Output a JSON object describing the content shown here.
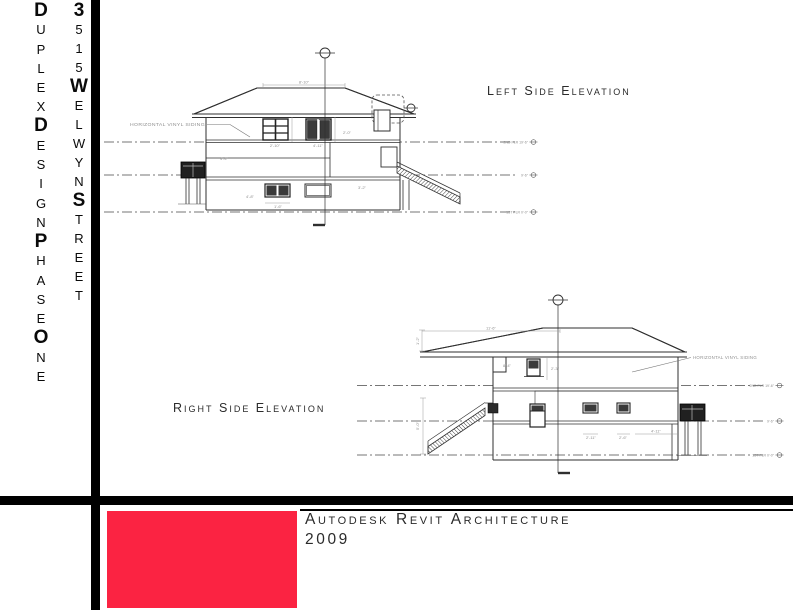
{
  "sidebar": {
    "column1": {
      "text": "DUPLEX DESIGN PHASE ONE",
      "letters": "DUPLEXDESIGNPHASEONE",
      "bold_indices": [
        0,
        6,
        12,
        17
      ]
    },
    "column2": {
      "text": "3515 WELWYN STREET",
      "letters": "3515WELWYNSTREET",
      "bold_indices": [
        0,
        4,
        10
      ]
    }
  },
  "drawings": {
    "left_elevation": {
      "title": "Left Side Elevation",
      "siding_label": "HORIZONTAL VINYL SIDING",
      "levels": [
        {
          "label": "2ND FLR 19'-6\""
        },
        {
          "label": "9'-6\""
        },
        {
          "label": "1ST FLR 0'-0\""
        }
      ],
      "dims": [
        "8'-10\"",
        "2'-10\"",
        "4'-11\"",
        "4'-4\"",
        "2'-0\"",
        "4'-8\"",
        "1'-6\"",
        "3'-2\""
      ]
    },
    "right_elevation": {
      "title": "Right Side Elevation",
      "siding_label": "HORIZONTAL VINYL SIDING",
      "levels": [
        {
          "label": "2ND FLR 19'-6\""
        },
        {
          "label": "9'-6\""
        },
        {
          "label": "1ST FLR 0'-0\""
        }
      ],
      "dims": [
        "2'-3\"",
        "2'-11\"",
        "2'-6\"",
        "4'-11\"",
        "8'-4\"",
        "5'-0\"",
        "1'-2\"",
        "11'-6\""
      ]
    }
  },
  "titleblock": {
    "software": "Autodesk Revit Architecture",
    "year": "2009"
  },
  "colors": {
    "accent_red": "#fb2342",
    "frame_black": "#000000"
  }
}
